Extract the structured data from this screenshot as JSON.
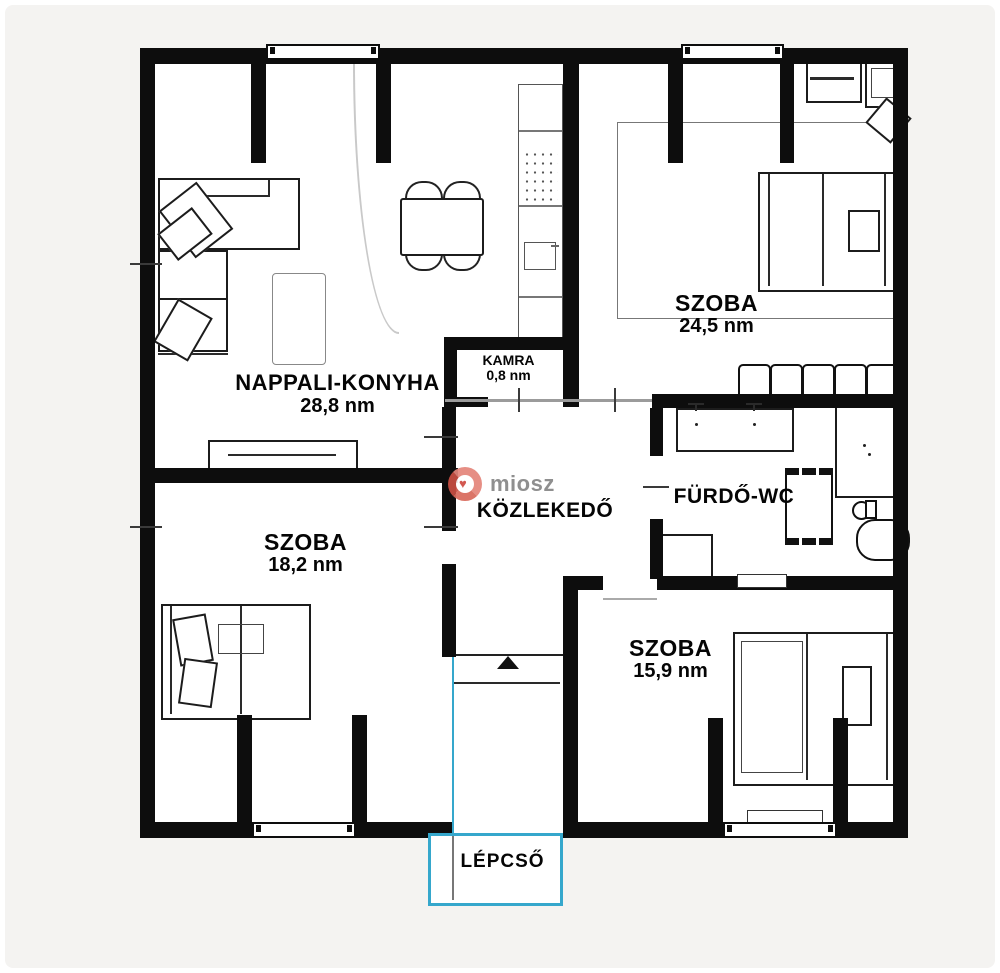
{
  "rooms": {
    "nappali": {
      "name": "NAPPALI-KONYHA",
      "area": "28,8 nm"
    },
    "szoba24": {
      "name": "SZOBA",
      "area": "24,5 nm"
    },
    "kamra": {
      "name": "KAMRA",
      "area": "0,8 nm"
    },
    "kozlekedo": {
      "name": "KÖZLEKEDŐ"
    },
    "furdo": {
      "name": "FÜRDŐ-WC"
    },
    "szoba18": {
      "name": "SZOBA",
      "area": "18,2 nm"
    },
    "szoba15": {
      "name": "SZOBA",
      "area": "15,9 nm"
    },
    "lepcso": {
      "name": "LÉPCSŐ"
    }
  },
  "watermark": {
    "text": "miosz",
    "ring_color": "#e0776b",
    "text_color": "#8f8f8f"
  },
  "colors": {
    "wall": "#0d0d0d",
    "thin_wall": "#9b9b9b",
    "stairs_accent": "#35a7cc",
    "background": "#f4f3f1",
    "floor": "#ffffff"
  }
}
